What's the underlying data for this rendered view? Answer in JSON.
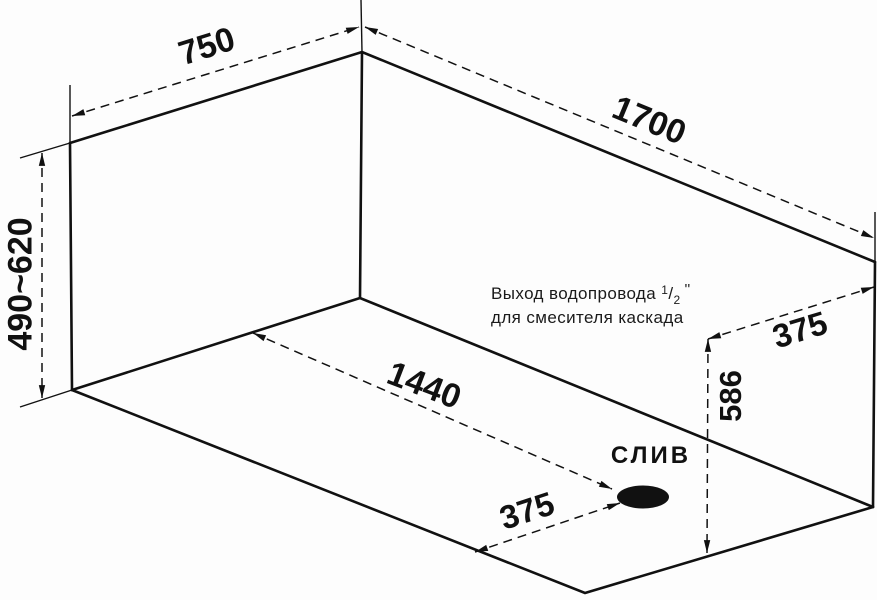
{
  "diagram": {
    "dimensions": {
      "top_width": "750",
      "top_length": "1700",
      "left_height_range": "490~620",
      "floor_diagonal": "1440",
      "drain_offset": "375",
      "outlet_wall_offset": "375",
      "outlet_wall_height": "586"
    },
    "labels": {
      "drain": "СЛИВ",
      "outlet_note": {
        "line1": "Выход водопровода",
        "size_numerator": "1",
        "size_slash": "/",
        "size_denominator": "2",
        "size_unit": "''",
        "line2": "для смесителя каскада"
      }
    },
    "colors": {
      "line": "#111111",
      "background": "#fdfdfd"
    }
  }
}
